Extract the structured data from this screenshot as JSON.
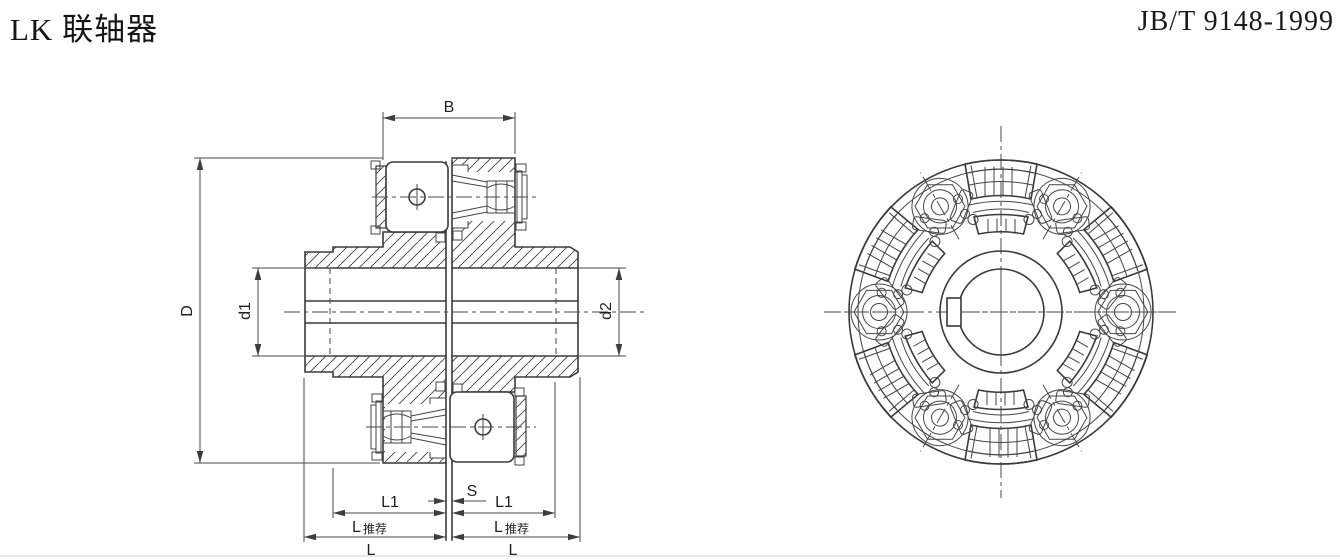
{
  "header": {
    "title": "LK 联轴器",
    "standard_code": "JB/T 9148-1999"
  },
  "drawing": {
    "dimension_labels": {
      "width_b": "B",
      "outer_diameter": "D",
      "bore_left": "d1",
      "bore_right": "d2",
      "hub_length": "L1",
      "gap": "S",
      "length_main": "L",
      "length_recommended_suffix": "推荐"
    }
  }
}
